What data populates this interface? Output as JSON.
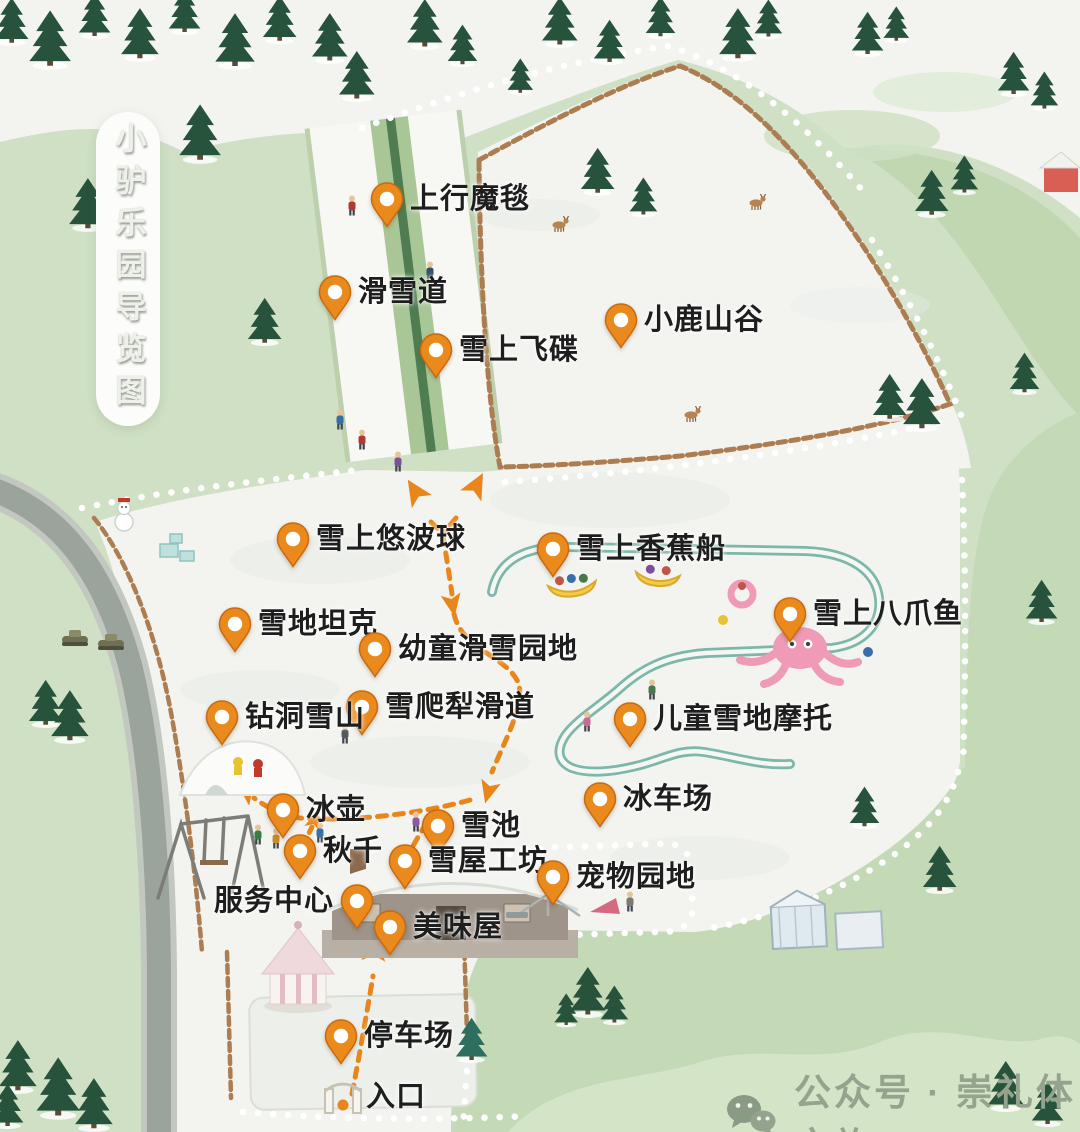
{
  "title": {
    "text": "小驴乐园导览图"
  },
  "watermark": {
    "icon": "wechat-icon",
    "label": "公众号 · 崇礼体文旅"
  },
  "colors": {
    "pin_orange": "#ea8a1c",
    "pin_edge": "#c96a10",
    "route_orange": "#e8861c",
    "track_teal": "#7db7ab",
    "fence_brown": "#ad7d52",
    "snow": "#f3f4f0",
    "grass": "#cfe0c5",
    "grass_dark": "#bdd4ad",
    "road_gray": "#9aa39c",
    "tree_green": "#27523c",
    "label_text": "#1e1e1e",
    "watermark_gray": "#95a38e"
  },
  "map": {
    "pois": [
      {
        "id": "uphill-magic-carpet",
        "label": "上行魔毯",
        "x": 387,
        "y": 199,
        "side": "right"
      },
      {
        "id": "ski-slope",
        "label": "滑雪道",
        "x": 335,
        "y": 292,
        "side": "right"
      },
      {
        "id": "snow-saucer",
        "label": "雪上飞碟",
        "x": 436,
        "y": 350,
        "side": "right"
      },
      {
        "id": "deer-valley",
        "label": "小鹿山谷",
        "x": 621,
        "y": 320,
        "side": "right"
      },
      {
        "id": "snow-zorb-ball",
        "label": "雪上悠波球",
        "x": 293,
        "y": 539,
        "side": "right"
      },
      {
        "id": "snow-banana-boat",
        "label": "雪上香蕉船",
        "x": 553,
        "y": 549,
        "side": "right"
      },
      {
        "id": "snow-tank",
        "label": "雪地坦克",
        "x": 235,
        "y": 624,
        "side": "right"
      },
      {
        "id": "snow-octopus",
        "label": "雪上八爪鱼",
        "x": 790,
        "y": 614,
        "side": "right"
      },
      {
        "id": "toddler-ski-area",
        "label": "幼童滑雪园地",
        "x": 375,
        "y": 649,
        "side": "right"
      },
      {
        "id": "snow-sled-slide",
        "label": "雪爬犁滑道",
        "x": 362,
        "y": 707,
        "side": "right"
      },
      {
        "id": "tunnel-snow-mountain",
        "label": "钻洞雪山",
        "x": 222,
        "y": 717,
        "side": "right"
      },
      {
        "id": "kids-snowmobile",
        "label": "儿童雪地摩托",
        "x": 630,
        "y": 719,
        "side": "right"
      },
      {
        "id": "curling",
        "label": "冰壶",
        "x": 283,
        "y": 810,
        "side": "right"
      },
      {
        "id": "ice-cart-rink",
        "label": "冰车场",
        "x": 600,
        "y": 799,
        "side": "right"
      },
      {
        "id": "snow-pool",
        "label": "雪池",
        "x": 438,
        "y": 826,
        "side": "right"
      },
      {
        "id": "swing",
        "label": "秋千",
        "x": 300,
        "y": 851,
        "side": "right"
      },
      {
        "id": "snow-house-workshop",
        "label": "雪屋工坊",
        "x": 405,
        "y": 861,
        "side": "right"
      },
      {
        "id": "pet-area",
        "label": "宠物园地",
        "x": 553,
        "y": 877,
        "side": "right"
      },
      {
        "id": "service-center",
        "label": "服务中心",
        "x": 357,
        "y": 901,
        "side": "left"
      },
      {
        "id": "tasty-house",
        "label": "美味屋",
        "x": 390,
        "y": 927,
        "side": "right"
      },
      {
        "id": "parking-lot",
        "label": "停车场",
        "x": 341,
        "y": 1036,
        "side": "right"
      },
      {
        "id": "entrance",
        "label": "入口",
        "x": 343,
        "y": 1097,
        "side": "right",
        "type": "gate"
      }
    ]
  },
  "decor": {
    "trees": [
      {
        "x": 12,
        "y": 46,
        "s": 0.85
      },
      {
        "x": 50,
        "y": 70,
        "s": 1.05
      },
      {
        "x": 95,
        "y": 40,
        "s": 0.8
      },
      {
        "x": 140,
        "y": 62,
        "s": 0.95
      },
      {
        "x": 185,
        "y": 36,
        "s": 0.8
      },
      {
        "x": 235,
        "y": 70,
        "s": 1.0
      },
      {
        "x": 280,
        "y": 44,
        "s": 0.85
      },
      {
        "x": 330,
        "y": 64,
        "s": 0.9
      },
      {
        "x": 425,
        "y": 50,
        "s": 0.9
      },
      {
        "x": 462,
        "y": 68,
        "s": 0.75
      },
      {
        "x": 560,
        "y": 48,
        "s": 0.9
      },
      {
        "x": 610,
        "y": 66,
        "s": 0.8
      },
      {
        "x": 660,
        "y": 40,
        "s": 0.75
      },
      {
        "x": 738,
        "y": 62,
        "s": 0.95
      },
      {
        "x": 768,
        "y": 40,
        "s": 0.7
      },
      {
        "x": 868,
        "y": 58,
        "s": 0.8
      },
      {
        "x": 896,
        "y": 44,
        "s": 0.65
      },
      {
        "x": 1014,
        "y": 98,
        "s": 0.8
      },
      {
        "x": 1044,
        "y": 112,
        "s": 0.7
      },
      {
        "x": 200,
        "y": 164,
        "s": 1.05
      },
      {
        "x": 88,
        "y": 232,
        "s": 0.95
      },
      {
        "x": 265,
        "y": 346,
        "s": 0.85
      },
      {
        "x": 357,
        "y": 102,
        "s": 0.9
      },
      {
        "x": 520,
        "y": 96,
        "s": 0.65
      },
      {
        "x": 598,
        "y": 196,
        "s": 0.85
      },
      {
        "x": 643,
        "y": 218,
        "s": 0.7
      },
      {
        "x": 932,
        "y": 218,
        "s": 0.85
      },
      {
        "x": 964,
        "y": 196,
        "s": 0.7
      },
      {
        "x": 890,
        "y": 422,
        "s": 0.85
      },
      {
        "x": 922,
        "y": 432,
        "s": 0.95
      },
      {
        "x": 1024,
        "y": 396,
        "s": 0.75
      },
      {
        "x": 1042,
        "y": 626,
        "s": 0.8
      },
      {
        "x": 46,
        "y": 728,
        "s": 0.85
      },
      {
        "x": 70,
        "y": 744,
        "s": 0.95
      },
      {
        "x": 864,
        "y": 830,
        "s": 0.75
      },
      {
        "x": 940,
        "y": 894,
        "s": 0.85
      },
      {
        "x": 588,
        "y": 1018,
        "s": 0.9
      },
      {
        "x": 614,
        "y": 1026,
        "s": 0.7
      },
      {
        "x": 566,
        "y": 1028,
        "s": 0.6
      },
      {
        "x": 472,
        "y": 1064,
        "s": 0.8,
        "t": "teal"
      },
      {
        "x": 1006,
        "y": 1112,
        "s": 0.9
      },
      {
        "x": 1048,
        "y": 1128,
        "s": 0.8
      },
      {
        "x": 18,
        "y": 1094,
        "s": 0.95
      },
      {
        "x": 58,
        "y": 1120,
        "s": 1.1
      },
      {
        "x": 94,
        "y": 1132,
        "s": 0.95
      },
      {
        "x": 8,
        "y": 1130,
        "s": 0.8
      }
    ],
    "figures": [
      {
        "x": 352,
        "y": 216,
        "c": "#b03a33"
      },
      {
        "x": 430,
        "y": 282,
        "c": "#31506e"
      },
      {
        "x": 398,
        "y": 472,
        "c": "#7a4f9e"
      },
      {
        "x": 362,
        "y": 450,
        "c": "#b03a33"
      },
      {
        "x": 340,
        "y": 430,
        "c": "#3a6ea8"
      },
      {
        "x": 587,
        "y": 732,
        "c": "#c96a96"
      },
      {
        "x": 652,
        "y": 700,
        "c": "#47784e"
      },
      {
        "x": 345,
        "y": 744,
        "c": "#55585e"
      },
      {
        "x": 416,
        "y": 832,
        "c": "#8e5aa8"
      },
      {
        "x": 258,
        "y": 845,
        "c": "#3a7d44"
      },
      {
        "x": 276,
        "y": 849,
        "c": "#c98a2a"
      },
      {
        "x": 320,
        "y": 843,
        "c": "#3a6ea8"
      },
      {
        "x": 630,
        "y": 912,
        "c": "#7a7a72"
      }
    ],
    "deer": [
      {
        "x": 560,
        "y": 232
      },
      {
        "x": 757,
        "y": 210
      },
      {
        "x": 692,
        "y": 422
      }
    ]
  }
}
